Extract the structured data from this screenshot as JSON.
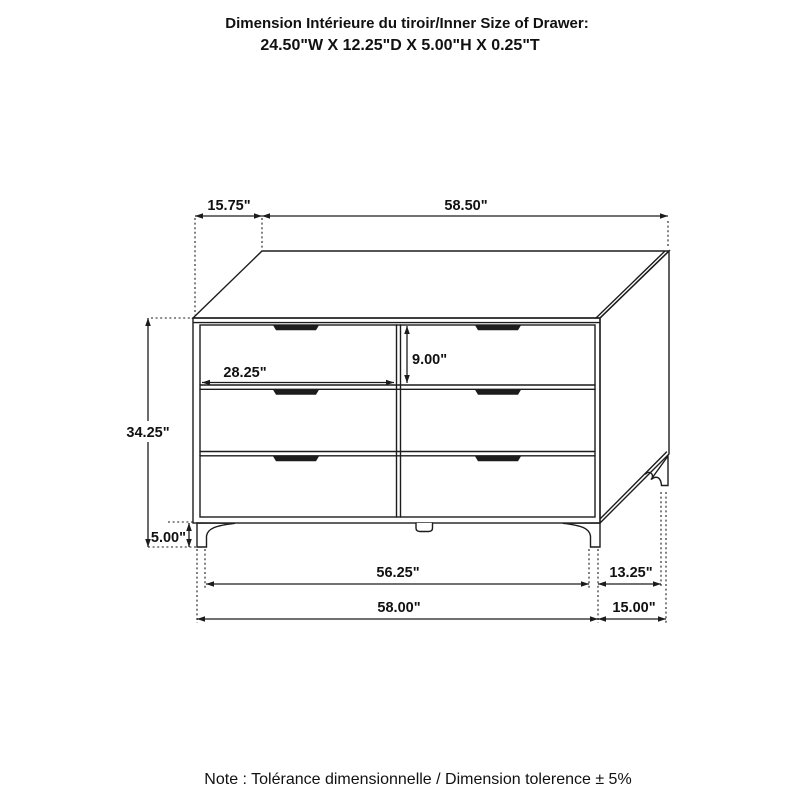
{
  "header": {
    "line1": "Dimension Intérieure du tiroir/Inner Size of Drawer:",
    "line2": "24.50\"W X 12.25\"D X 5.00\"H X 0.25\"T"
  },
  "footer": {
    "note": "Note : Tolérance dimensionnelle / Dimension tolerence  ± 5%"
  },
  "dimensions": {
    "top_depth": "15.75\"",
    "top_width": "58.50\"",
    "overall_height": "34.25\"",
    "leg_height": "5.00\"",
    "drawer_width": "28.25\"",
    "drawer_front_height": "9.00\"",
    "base_width": "56.25\"",
    "overall_width": "58.00\"",
    "base_depth": "13.25\"",
    "overall_depth": "15.00\""
  },
  "style": {
    "line_color": "#1c1c1c",
    "background_color": "#ffffff",
    "text_color": "#111111"
  },
  "subject": {
    "type": "dresser line drawing",
    "drawer_count": "6"
  }
}
